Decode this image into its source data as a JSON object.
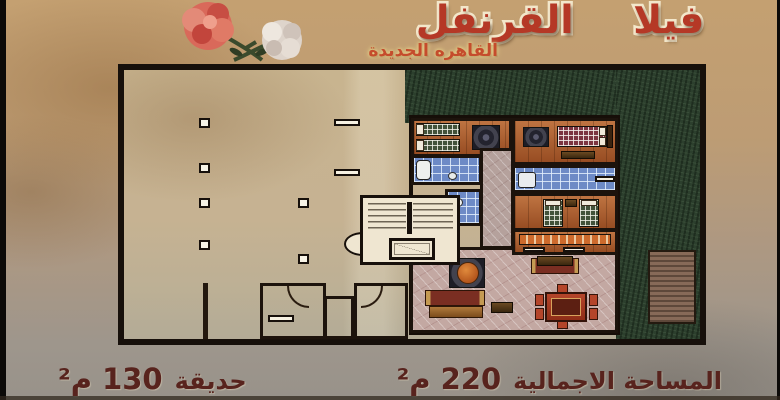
{
  "poster": {
    "title": "فيلا القرنفل",
    "subtitle": "القاهره الجديدة",
    "footer": {
      "total_area_label": "المساحة الاجمالية",
      "total_area_value": "220 م²",
      "garden_label": "حديقة",
      "garden_value": "130 م²"
    },
    "colors": {
      "title_red": "#b53826",
      "subtitle_red": "#c54c2c",
      "footer_maroon": "#58231d",
      "poster_tan": "#c4a071",
      "plan_beige": "#c6b292",
      "garden_green": "#2c3f2d",
      "wall_black": "#1c130c",
      "bathroom_tile_blue": "#6d8ac6",
      "wood_floor": "#a9592c",
      "marble_pink": "#c3a8a2",
      "flower_red": "#d9695a",
      "flower_white": "#ded4cb"
    }
  }
}
